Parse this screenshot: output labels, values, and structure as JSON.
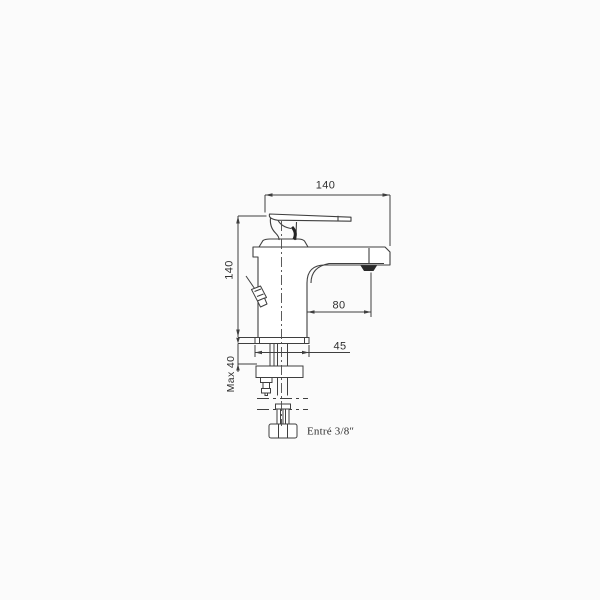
{
  "canvas": {
    "background": "#fbfbfb",
    "line_color": "#3f3f3f",
    "dark_accent": "#232323",
    "text_color": "#2f2f2f"
  },
  "drawing": {
    "dimensions": {
      "top_width": {
        "label": "140",
        "orientation": "horizontal"
      },
      "left_height": {
        "label": "140",
        "orientation": "vertical"
      },
      "spout_reach": {
        "label": "80",
        "orientation": "horizontal"
      },
      "base_width": {
        "label": "45",
        "orientation": "horizontal"
      },
      "max_deck_thickness": {
        "label": "Max 40",
        "orientation": "vertical"
      }
    },
    "annotations": {
      "inlet": {
        "label": "Entré 3/8″"
      }
    }
  }
}
